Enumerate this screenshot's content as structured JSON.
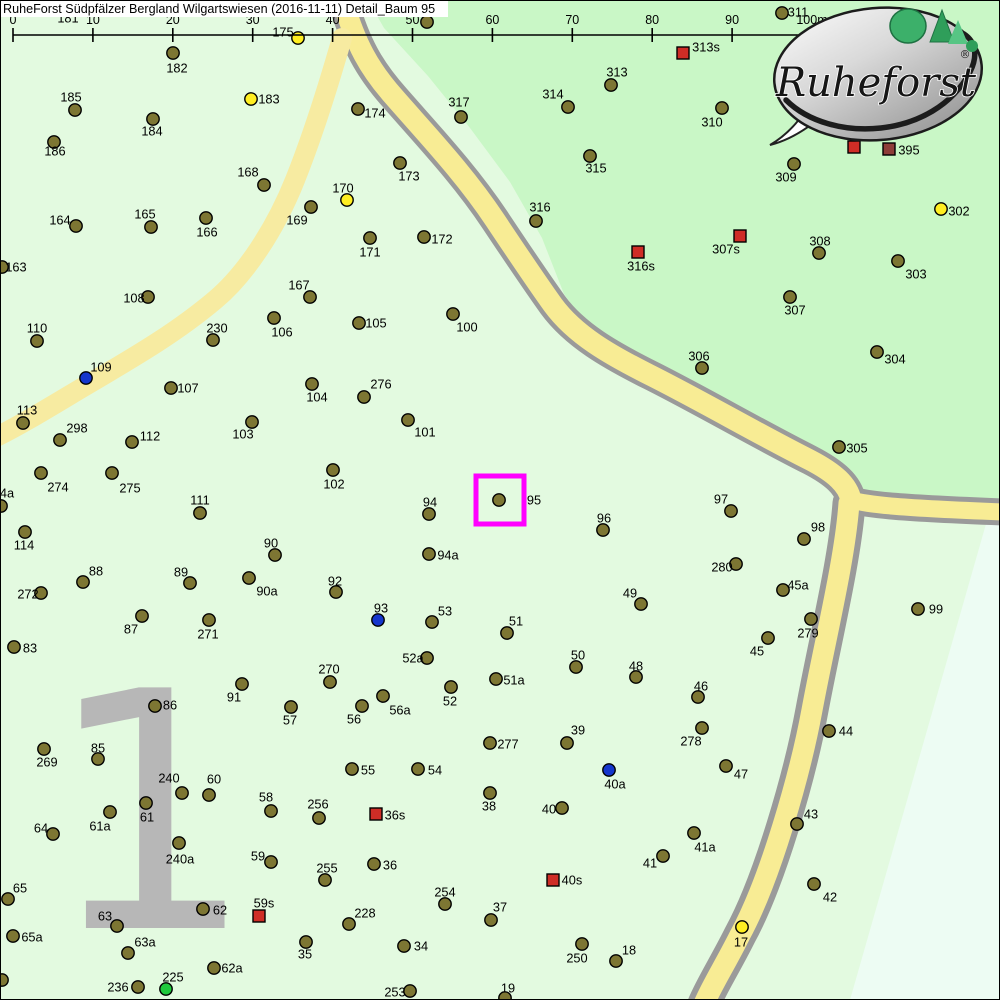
{
  "header": {
    "title": "RuheForst Südpfälzer Bergland Wilgartswiesen (2016-11-11) Detail_Baum 95"
  },
  "scale_bar": {
    "ticks": [
      "0",
      "10",
      "20",
      "30",
      "40",
      "50",
      "60",
      "70",
      "80",
      "90",
      "100m"
    ],
    "x0": 13,
    "step": 79.9,
    "y": 35,
    "tick_top": 28,
    "tick_bottom": 42,
    "label_y": 24
  },
  "district": {
    "label": "1",
    "color": "#b7b7b7"
  },
  "logo": {
    "brand": "Ruheforst",
    "reg": "®"
  },
  "highlight": {
    "tree": "95",
    "x": 476,
    "y": 476,
    "size": 48,
    "color": "#ff00ff"
  },
  "map": {
    "colors": {
      "light": "#e3fae0",
      "dark": "#c9f7c6",
      "pale": "#edfcf3",
      "road_fill": "#f8ec94",
      "road_border": "#9a9a9a",
      "path_fill": "#f7eba1"
    },
    "marker_colors": {
      "t": "#7d7633",
      "y": "#ffee22",
      "b": "#1536cc",
      "g": "#1fc93c",
      "r": "#cf2d26",
      "dr": "#8e3d39"
    },
    "regions": {
      "dark_poly": "368,0 384,28 428,76 470,128 510,182 542,238 564,294 590,330 634,362 702,412 780,452 836,482 856,492 1000,500 1000,0",
      "pale_poly": "986,524 1000,524 1000,1000 850,1000"
    },
    "roads": {
      "main": "M341,-6 C355,45 370,70 395,98 C430,138 465,175 495,220 C515,250 535,280 553,305 C575,335 610,355 650,375 C700,400 760,435 810,460 C835,473 848,485 851,500",
      "branch_right": "M851,500 C870,505 900,508 1004,512",
      "branch_down": "M849,503 C845,560 825,640 812,710 C800,775 770,880 740,935 C725,965 712,985 704,1004",
      "small": "M342,38 C330,80 315,130 295,180 C275,230 245,275 215,300 C170,338 120,365 70,395 C40,413 15,428 -6,438"
    },
    "markers": [
      [
        "181",
        null,
        null,
        68,
        18,
        "t"
      ],
      [
        "182",
        173,
        53,
        177,
        68,
        "t"
      ],
      [
        "185",
        75,
        110,
        71,
        97,
        "t"
      ],
      [
        "183",
        251,
        99,
        269,
        99,
        "y"
      ],
      [
        "184",
        153,
        119,
        152,
        131,
        "t"
      ],
      [
        "186",
        54,
        142,
        55,
        151,
        "t"
      ],
      [
        "168",
        264,
        185,
        248,
        172,
        "t"
      ],
      [
        "311",
        782,
        13,
        798,
        12,
        "t"
      ],
      [
        "318",
        427,
        22,
        430,
        7,
        "t"
      ],
      [
        "175",
        298,
        38,
        283,
        32,
        "y"
      ],
      [
        "313s",
        683,
        53,
        706,
        47,
        "r"
      ],
      [
        "313",
        611,
        85,
        617,
        72,
        "t"
      ],
      [
        "314",
        568,
        107,
        553,
        94,
        "t"
      ],
      [
        "317",
        461,
        117,
        459,
        102,
        "t"
      ],
      [
        "174",
        358,
        109,
        375,
        113,
        "t"
      ],
      [
        "310",
        722,
        108,
        712,
        122,
        "t"
      ],
      [
        "309",
        794,
        164,
        786,
        177,
        "t"
      ],
      [
        "395",
        889,
        149,
        909,
        150,
        "dr"
      ],
      [
        "",
        854,
        147,
        null,
        null,
        "r"
      ],
      [
        "315",
        590,
        156,
        596,
        168,
        "t"
      ],
      [
        "164",
        76,
        226,
        60,
        220,
        "t"
      ],
      [
        "165",
        151,
        227,
        145,
        214,
        "t"
      ],
      [
        "166",
        206,
        218,
        207,
        232,
        "t"
      ],
      [
        "169",
        311,
        207,
        297,
        220,
        "t"
      ],
      [
        "170",
        347,
        200,
        343,
        188,
        "y"
      ],
      [
        "173",
        400,
        163,
        409,
        176,
        "t"
      ],
      [
        "172",
        424,
        237,
        442,
        239,
        "t"
      ],
      [
        "171",
        370,
        238,
        370,
        252,
        "t"
      ],
      [
        "316",
        536,
        221,
        540,
        207,
        "t"
      ],
      [
        "316s",
        638,
        252,
        641,
        266,
        "r"
      ],
      [
        "307s",
        740,
        236,
        726,
        249,
        "r"
      ],
      [
        "308",
        819,
        253,
        820,
        241,
        "t"
      ],
      [
        "302",
        941,
        209,
        959,
        211,
        "y"
      ],
      [
        "303",
        898,
        261,
        916,
        274,
        "t"
      ],
      [
        "307",
        790,
        297,
        795,
        310,
        "t"
      ],
      [
        "304",
        877,
        352,
        895,
        359,
        "t"
      ],
      [
        "306",
        702,
        368,
        699,
        356,
        "t"
      ],
      [
        "163",
        2,
        267,
        16,
        267,
        "t"
      ],
      [
        "108",
        148,
        297,
        134,
        298,
        "t"
      ],
      [
        "110",
        37,
        341,
        37,
        328,
        "t"
      ],
      [
        "230",
        213,
        340,
        217,
        328,
        "t"
      ],
      [
        "106",
        274,
        318,
        282,
        332,
        "t"
      ],
      [
        "167",
        310,
        297,
        299,
        285,
        "t"
      ],
      [
        "105",
        359,
        323,
        376,
        323,
        "t"
      ],
      [
        "100",
        453,
        314,
        467,
        327,
        "t"
      ],
      [
        "109",
        86,
        378,
        101,
        367,
        "b"
      ],
      [
        "107",
        171,
        388,
        188,
        388,
        "t"
      ],
      [
        "104",
        312,
        384,
        317,
        397,
        "t"
      ],
      [
        "276",
        364,
        397,
        381,
        384,
        "t"
      ],
      [
        "113",
        23,
        423,
        27,
        410,
        "t"
      ],
      [
        "298",
        60,
        440,
        77,
        428,
        "t"
      ],
      [
        "112",
        132,
        442,
        150,
        436,
        "t"
      ],
      [
        "103",
        252,
        422,
        243,
        434,
        "t"
      ],
      [
        "101",
        408,
        420,
        425,
        432,
        "t"
      ],
      [
        "305",
        839,
        447,
        857,
        448,
        "t"
      ],
      [
        "274",
        41,
        473,
        58,
        487,
        "t"
      ],
      [
        "275",
        112,
        473,
        130,
        488,
        "t"
      ],
      [
        "102",
        333,
        470,
        334,
        484,
        "t"
      ],
      [
        "111",
        200,
        513,
        200,
        500,
        "t"
      ],
      [
        "4a",
        1,
        506,
        7,
        493,
        "t"
      ],
      [
        "95",
        499,
        500,
        534,
        500,
        "t"
      ],
      [
        "94",
        429,
        514,
        430,
        502,
        "t"
      ],
      [
        "97",
        731,
        511,
        721,
        499,
        "t"
      ],
      [
        "96",
        603,
        530,
        604,
        518,
        "t"
      ],
      [
        "98",
        804,
        539,
        818,
        527,
        "t"
      ],
      [
        "114",
        25,
        532,
        24,
        545,
        "t"
      ],
      [
        "94a",
        429,
        554,
        448,
        555,
        "t"
      ],
      [
        "280",
        736,
        564,
        722,
        567,
        "t"
      ],
      [
        "90",
        275,
        555,
        271,
        543,
        "t"
      ],
      [
        "88",
        83,
        582,
        96,
        571,
        "t"
      ],
      [
        "89",
        190,
        583,
        181,
        572,
        "t"
      ],
      [
        "90a",
        249,
        578,
        267,
        591,
        "t"
      ],
      [
        "92",
        336,
        592,
        335,
        581,
        "t"
      ],
      [
        "272",
        41,
        593,
        28,
        594,
        "t"
      ],
      [
        "45a",
        783,
        590,
        798,
        585,
        "t"
      ],
      [
        "99",
        918,
        609,
        936,
        609,
        "t"
      ],
      [
        "49",
        641,
        604,
        630,
        593,
        "t"
      ],
      [
        "93",
        378,
        620,
        381,
        608,
        "b"
      ],
      [
        "53",
        432,
        622,
        445,
        611,
        "t"
      ],
      [
        "51",
        507,
        633,
        516,
        621,
        "t"
      ],
      [
        "279",
        811,
        619,
        808,
        633,
        "t"
      ],
      [
        "87",
        142,
        616,
        131,
        629,
        "t"
      ],
      [
        "271",
        209,
        620,
        208,
        634,
        "t"
      ],
      [
        "83",
        14,
        647,
        30,
        648,
        "t"
      ],
      [
        "45",
        768,
        638,
        757,
        651,
        "t"
      ],
      [
        "52a",
        427,
        658,
        413,
        658,
        "t"
      ],
      [
        "50",
        576,
        667,
        578,
        655,
        "t"
      ],
      [
        "48",
        636,
        677,
        636,
        666,
        "t"
      ],
      [
        "51a",
        496,
        679,
        514,
        680,
        "t"
      ],
      [
        "270",
        330,
        682,
        329,
        669,
        "t"
      ],
      [
        "52",
        451,
        687,
        450,
        701,
        "t"
      ],
      [
        "46",
        698,
        697,
        701,
        686,
        "t"
      ],
      [
        "56a",
        383,
        696,
        400,
        710,
        "t"
      ],
      [
        "91",
        242,
        684,
        234,
        697,
        "t"
      ],
      [
        "86",
        155,
        706,
        170,
        705,
        "t"
      ],
      [
        "57",
        291,
        707,
        290,
        720,
        "t"
      ],
      [
        "56",
        362,
        706,
        354,
        719,
        "t"
      ],
      [
        "44",
        829,
        731,
        846,
        731,
        "t"
      ],
      [
        "278",
        702,
        728,
        691,
        741,
        "t"
      ],
      [
        "39",
        567,
        743,
        578,
        730,
        "t"
      ],
      [
        "277",
        490,
        743,
        508,
        744,
        "t"
      ],
      [
        "269",
        44,
        749,
        47,
        762,
        "t"
      ],
      [
        "85",
        98,
        759,
        98,
        748,
        "t"
      ],
      [
        "47",
        726,
        766,
        741,
        774,
        "t"
      ],
      [
        "55",
        352,
        769,
        368,
        770,
        "t"
      ],
      [
        "54",
        418,
        769,
        435,
        770,
        "t"
      ],
      [
        "40a",
        609,
        770,
        615,
        784,
        "b"
      ],
      [
        "240",
        182,
        793,
        169,
        778,
        "t"
      ],
      [
        "60",
        209,
        795,
        214,
        779,
        "t"
      ],
      [
        "38",
        490,
        793,
        489,
        806,
        "t"
      ],
      [
        "36s",
        376,
        814,
        395,
        815,
        "r"
      ],
      [
        "40",
        562,
        808,
        549,
        809,
        "t"
      ],
      [
        "58",
        271,
        811,
        266,
        797,
        "t"
      ],
      [
        "256",
        319,
        818,
        318,
        804,
        "t"
      ],
      [
        "61",
        146,
        803,
        147,
        817,
        "t"
      ],
      [
        "61a",
        110,
        812,
        100,
        826,
        "t"
      ],
      [
        "64",
        53,
        834,
        41,
        828,
        "t"
      ],
      [
        "43",
        797,
        824,
        811,
        814,
        "t"
      ],
      [
        "41a",
        694,
        833,
        705,
        847,
        "t"
      ],
      [
        "41",
        663,
        856,
        650,
        863,
        "t"
      ],
      [
        "240a",
        179,
        843,
        180,
        859,
        "t"
      ],
      [
        "59",
        271,
        862,
        258,
        856,
        "t"
      ],
      [
        "255",
        325,
        880,
        327,
        868,
        "t"
      ],
      [
        "42",
        814,
        884,
        830,
        897,
        "t"
      ],
      [
        "40s",
        553,
        880,
        572,
        880,
        "r"
      ],
      [
        "65",
        8,
        899,
        20,
        888,
        "t"
      ],
      [
        "62",
        203,
        909,
        220,
        910,
        "t"
      ],
      [
        "59s",
        259,
        916,
        264,
        903,
        "r"
      ],
      [
        "63",
        117,
        926,
        105,
        916,
        "t"
      ],
      [
        "228",
        349,
        924,
        365,
        913,
        "t"
      ],
      [
        "36",
        374,
        864,
        390,
        865,
        "t"
      ],
      [
        "254",
        445,
        904,
        445,
        892,
        "t"
      ],
      [
        "37",
        491,
        920,
        500,
        907,
        "t"
      ],
      [
        "34",
        404,
        946,
        421,
        946,
        "t"
      ],
      [
        "35",
        306,
        942,
        305,
        954,
        "t"
      ],
      [
        "250",
        582,
        944,
        577,
        958,
        "t"
      ],
      [
        "18",
        616,
        961,
        629,
        950,
        "t"
      ],
      [
        "17",
        742,
        927,
        741,
        942,
        "y"
      ],
      [
        "65a",
        13,
        936,
        32,
        937,
        "t"
      ],
      [
        "63a",
        128,
        953,
        145,
        942,
        "t"
      ],
      [
        "62a",
        214,
        968,
        232,
        968,
        "t"
      ],
      [
        "253",
        410,
        991,
        395,
        992,
        "t"
      ],
      [
        "19",
        505,
        998,
        508,
        988,
        "t"
      ],
      [
        "225",
        166,
        989,
        173,
        977,
        "g"
      ],
      [
        "236",
        138,
        987,
        118,
        987,
        "t"
      ],
      [
        "",
        2,
        980,
        null,
        null,
        "t"
      ]
    ]
  }
}
